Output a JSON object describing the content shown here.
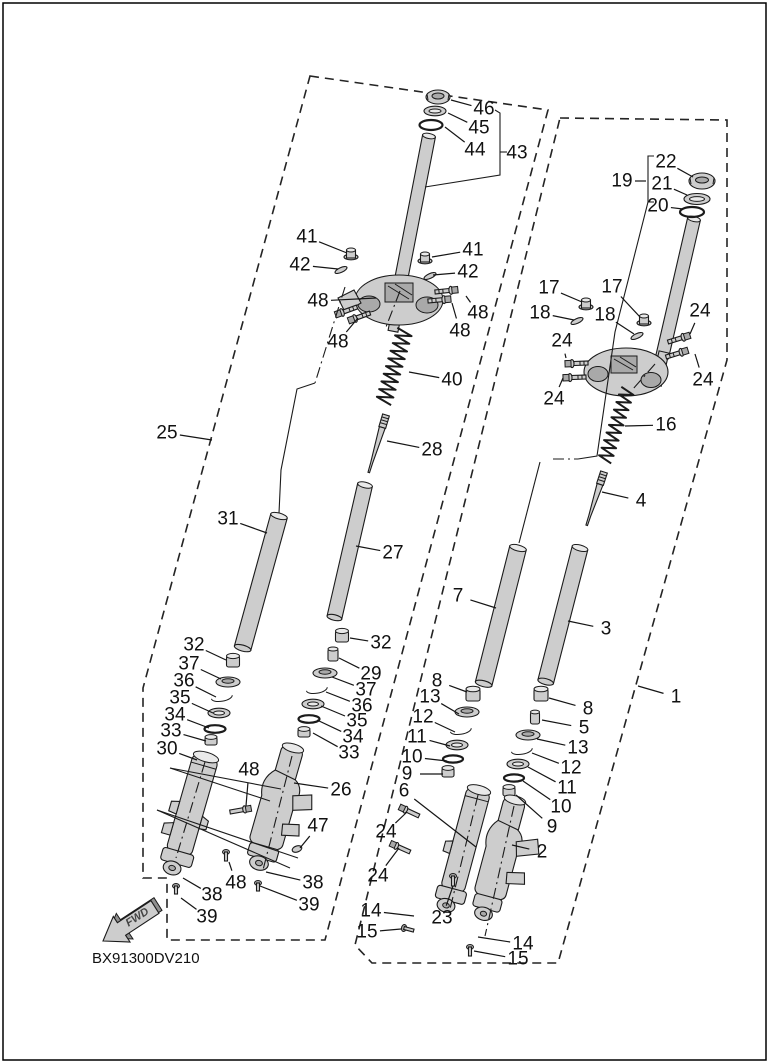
{
  "diagram": {
    "code": "BX91300DV210",
    "fwd_label": "FWD",
    "ink_color": "#1b1b1b",
    "paper_color": "#ffffff",
    "part_fill_color": "#cdcdcd",
    "left_assembly_label": "25",
    "right_assembly_label": "1"
  },
  "callouts": [
    {
      "text": "46",
      "x": 484,
      "y": 109,
      "tx": 451,
      "ty": 100
    },
    {
      "text": "45",
      "x": 479,
      "y": 128,
      "tx": 448,
      "ty": 113
    },
    {
      "text": "44",
      "x": 475,
      "y": 150,
      "tx": 445,
      "ty": 127
    },
    {
      "text": "43",
      "x": 517,
      "y": 153
    },
    {
      "text": "41",
      "x": 307,
      "y": 237,
      "tx": 347,
      "ty": 253
    },
    {
      "text": "42",
      "x": 300,
      "y": 265,
      "tx": 338,
      "ty": 269
    },
    {
      "text": "41",
      "x": 473,
      "y": 250,
      "tx": 432,
      "ty": 257
    },
    {
      "text": "42",
      "x": 468,
      "y": 272,
      "tx": 433,
      "ty": 275
    },
    {
      "text": "48",
      "x": 318,
      "y": 301,
      "tx": 376,
      "ty": 298
    },
    {
      "text": "48",
      "x": 338,
      "y": 342,
      "tx": 358,
      "ty": 318
    },
    {
      "text": "48",
      "x": 478,
      "y": 313,
      "tx": 466,
      "ty": 296
    },
    {
      "text": "48",
      "x": 460,
      "y": 331,
      "tx": 452,
      "ty": 303
    },
    {
      "text": "40",
      "x": 452,
      "y": 380,
      "tx": 409,
      "ty": 372
    },
    {
      "text": "28",
      "x": 432,
      "y": 450,
      "tx": 387,
      "ty": 441
    },
    {
      "text": "25",
      "x": 167,
      "y": 433,
      "tx": 212,
      "ty": 440
    },
    {
      "text": "31",
      "x": 228,
      "y": 519,
      "tx": 267,
      "ty": 533
    },
    {
      "text": "27",
      "x": 393,
      "y": 553,
      "tx": 356,
      "ty": 546
    },
    {
      "text": "32",
      "x": 194,
      "y": 645,
      "tx": 226,
      "ty": 660
    },
    {
      "text": "37",
      "x": 189,
      "y": 664,
      "tx": 221,
      "ty": 679
    },
    {
      "text": "36",
      "x": 184,
      "y": 681,
      "tx": 216,
      "ty": 697
    },
    {
      "text": "35",
      "x": 180,
      "y": 698,
      "tx": 213,
      "ty": 713
    },
    {
      "text": "34",
      "x": 175,
      "y": 715,
      "tx": 209,
      "ty": 728
    },
    {
      "text": "33",
      "x": 171,
      "y": 731,
      "tx": 206,
      "ty": 741
    },
    {
      "text": "30",
      "x": 167,
      "y": 749,
      "tx": 197,
      "ty": 760
    },
    {
      "text": "32",
      "x": 381,
      "y": 643,
      "tx": 350,
      "ty": 638
    },
    {
      "text": "29",
      "x": 371,
      "y": 674,
      "tx": 339,
      "ty": 658
    },
    {
      "text": "37",
      "x": 366,
      "y": 690,
      "tx": 332,
      "ty": 677
    },
    {
      "text": "36",
      "x": 362,
      "y": 706,
      "tx": 326,
      "ty": 692
    },
    {
      "text": "35",
      "x": 357,
      "y": 721,
      "tx": 321,
      "ty": 706
    },
    {
      "text": "34",
      "x": 353,
      "y": 737,
      "tx": 317,
      "ty": 720
    },
    {
      "text": "33",
      "x": 349,
      "y": 753,
      "tx": 313,
      "ty": 733
    },
    {
      "text": "48",
      "x": 249,
      "y": 770,
      "tx": 246,
      "ty": 806
    },
    {
      "text": "26",
      "x": 341,
      "y": 790,
      "tx": 294,
      "ty": 783
    },
    {
      "text": "47",
      "x": 318,
      "y": 826,
      "tx": 300,
      "ty": 848
    },
    {
      "text": "48",
      "x": 236,
      "y": 883,
      "tx": 229,
      "ty": 862
    },
    {
      "text": "38",
      "x": 212,
      "y": 895,
      "tx": 183,
      "ty": 878
    },
    {
      "text": "39",
      "x": 207,
      "y": 917,
      "tx": 181,
      "ty": 898
    },
    {
      "text": "38",
      "x": 313,
      "y": 883,
      "tx": 266,
      "ty": 872
    },
    {
      "text": "39",
      "x": 309,
      "y": 905,
      "tx": 260,
      "ty": 886
    },
    {
      "text": "22",
      "x": 666,
      "y": 162,
      "tx": 693,
      "ty": 177
    },
    {
      "text": "21",
      "x": 662,
      "y": 184,
      "tx": 687,
      "ty": 195
    },
    {
      "text": "20",
      "x": 658,
      "y": 206,
      "tx": 683,
      "ty": 209
    },
    {
      "text": "19",
      "x": 622,
      "y": 181,
      "tx": 646,
      "ty": 181
    },
    {
      "text": "17",
      "x": 549,
      "y": 288,
      "tx": 582,
      "ty": 302
    },
    {
      "text": "17",
      "x": 612,
      "y": 287,
      "tx": 640,
      "ty": 317
    },
    {
      "text": "18",
      "x": 540,
      "y": 313,
      "tx": 574,
      "ty": 320
    },
    {
      "text": "18",
      "x": 605,
      "y": 315,
      "tx": 634,
      "ty": 334
    },
    {
      "text": "24",
      "x": 562,
      "y": 341,
      "tx": 566,
      "ty": 358
    },
    {
      "text": "24",
      "x": 554,
      "y": 399,
      "tx": 563,
      "ty": 378
    },
    {
      "text": "24",
      "x": 700,
      "y": 311,
      "tx": 690,
      "ty": 334
    },
    {
      "text": "24",
      "x": 703,
      "y": 380,
      "tx": 695,
      "ty": 354
    },
    {
      "text": "16",
      "x": 666,
      "y": 425,
      "tx": 625,
      "ty": 426
    },
    {
      "text": "4",
      "x": 641,
      "y": 501,
      "tx": 602,
      "ty": 492
    },
    {
      "text": "7",
      "x": 458,
      "y": 596,
      "tx": 496,
      "ty": 608
    },
    {
      "text": "3",
      "x": 606,
      "y": 629,
      "tx": 568,
      "ty": 621
    },
    {
      "text": "1",
      "x": 676,
      "y": 697,
      "tx": 638,
      "ty": 686
    },
    {
      "text": "8",
      "x": 437,
      "y": 681,
      "tx": 467,
      "ty": 692
    },
    {
      "text": "13",
      "x": 430,
      "y": 697,
      "tx": 459,
      "ty": 714
    },
    {
      "text": "12",
      "x": 423,
      "y": 717,
      "tx": 455,
      "ty": 732
    },
    {
      "text": "11",
      "x": 417,
      "y": 737,
      "tx": 450,
      "ty": 746
    },
    {
      "text": "10",
      "x": 412,
      "y": 757,
      "tx": 447,
      "ty": 761
    },
    {
      "text": "9",
      "x": 407,
      "y": 774,
      "tx": 443,
      "ty": 774
    },
    {
      "text": "6",
      "x": 404,
      "y": 791,
      "tx": 476,
      "ty": 847
    },
    {
      "text": "8",
      "x": 588,
      "y": 709,
      "tx": 549,
      "ty": 698
    },
    {
      "text": "5",
      "x": 584,
      "y": 728,
      "tx": 542,
      "ty": 720
    },
    {
      "text": "13",
      "x": 578,
      "y": 748,
      "tx": 537,
      "ty": 739
    },
    {
      "text": "12",
      "x": 571,
      "y": 768,
      "tx": 532,
      "ty": 753
    },
    {
      "text": "11",
      "x": 567,
      "y": 788,
      "tx": 528,
      "ty": 767
    },
    {
      "text": "10",
      "x": 561,
      "y": 807,
      "tx": 523,
      "ty": 781
    },
    {
      "text": "9",
      "x": 552,
      "y": 827,
      "tx": 516,
      "ty": 795
    },
    {
      "text": "2",
      "x": 542,
      "y": 852,
      "tx": 512,
      "ty": 845
    },
    {
      "text": "24",
      "x": 386,
      "y": 832,
      "tx": 407,
      "ty": 812
    },
    {
      "text": "24",
      "x": 378,
      "y": 876,
      "tx": 399,
      "ty": 848
    },
    {
      "text": "14",
      "x": 371,
      "y": 911,
      "tx": 414,
      "ty": 916
    },
    {
      "text": "15",
      "x": 367,
      "y": 932,
      "tx": 401,
      "ty": 929
    },
    {
      "text": "23",
      "x": 442,
      "y": 918,
      "tx": 453,
      "ty": 886
    },
    {
      "text": "14",
      "x": 523,
      "y": 944,
      "tx": 478,
      "ty": 937
    },
    {
      "text": "15",
      "x": 518,
      "y": 959,
      "tx": 474,
      "ty": 951
    }
  ],
  "assembly_lines": {
    "solid": [
      [
        [
          495,
          110
        ],
        [
          500,
          113
        ],
        [
          500,
          175
        ],
        [
          425,
          187
        ]
      ],
      [
        [
          500,
          152
        ],
        [
          507,
          152
        ]
      ],
      [
        [
          654,
          156
        ],
        [
          648,
          156
        ],
        [
          648,
          202
        ],
        [
          654,
          202
        ]
      ],
      [
        [
          648,
          202
        ],
        [
          615,
          332
        ],
        [
          597,
          456
        ],
        [
          578,
          459
        ]
      ],
      [
        [
          540,
          462
        ],
        [
          519,
          543
        ]
      ],
      [
        [
          315,
          383
        ],
        [
          297,
          389
        ],
        [
          281,
          470
        ],
        [
          279,
          513
        ]
      ],
      [
        [
          170,
          768
        ],
        [
          281,
          789
        ]
      ],
      [
        [
          170,
          768
        ],
        [
          270,
          801
        ]
      ],
      [
        [
          157,
          810
        ],
        [
          298,
          858
        ]
      ],
      [
        [
          157,
          810
        ],
        [
          290,
          868
        ]
      ]
    ],
    "dashdot": [
      [
        [
          553,
          459
        ],
        [
          578,
          459
        ]
      ],
      [
        [
          655,
          364
        ],
        [
          633,
          389
        ]
      ],
      [
        [
          345,
          287
        ],
        [
          315,
          383
        ]
      ],
      [
        [
          400,
          291
        ],
        [
          386,
          327
        ]
      ],
      [
        [
          205,
          762
        ],
        [
          176,
          858
        ]
      ],
      [
        [
          292,
          756
        ],
        [
          263,
          870
        ]
      ],
      [
        [
          478,
          795
        ],
        [
          449,
          913
        ]
      ],
      [
        [
          514,
          806
        ],
        [
          485,
          936
        ]
      ]
    ]
  }
}
